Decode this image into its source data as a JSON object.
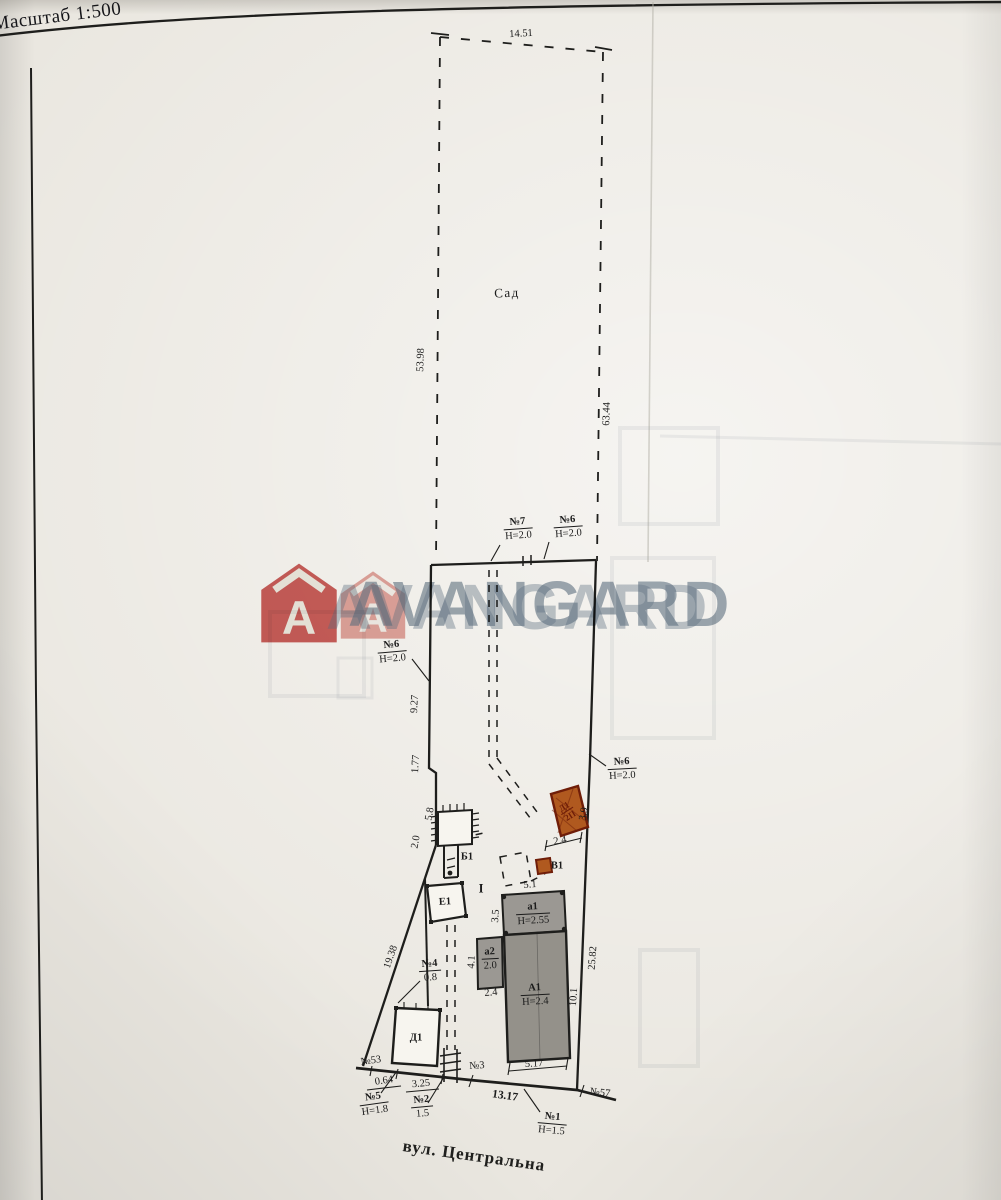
{
  "page": {
    "scale_label": "Масштаб 1:500",
    "street_label": "вул. Центральна"
  },
  "watermark": {
    "text": "AVANGARD",
    "logo_letter": "A"
  },
  "colors": {
    "ink": "#1e1e1c",
    "red_building": "#b0591f",
    "red_border": "#6f1d08",
    "gray_building": "#9b9893",
    "gray_building2": "#94918a",
    "wm_red": "#c64a47",
    "wm_red_light": "#d06156",
    "wm_blue": "#5e7286"
  },
  "plan": {
    "labels": [
      {
        "t": "14.51",
        "x": 521,
        "y": 34,
        "r": -3,
        "c": "dim"
      },
      {
        "t": "Сад",
        "x": 507,
        "y": 293,
        "r": -2,
        "c": "area"
      },
      {
        "t": "53.98",
        "x": 421,
        "y": 360,
        "r": -88,
        "c": "dim"
      },
      {
        "t": "63.44",
        "x": 607,
        "y": 414,
        "r": -88,
        "c": "dim"
      },
      {
        "t": "9.27",
        "x": 415,
        "y": 704,
        "r": -87,
        "c": "dim"
      },
      {
        "t": "1.77",
        "x": 416,
        "y": 764,
        "r": -87,
        "c": "dim"
      },
      {
        "t": "5.8",
        "x": 430,
        "y": 814,
        "r": -80,
        "c": "dim"
      },
      {
        "t": "2.0",
        "x": 416,
        "y": 842,
        "r": -80,
        "c": "dim"
      },
      {
        "t": "3.9",
        "x": 584,
        "y": 814,
        "r": -80,
        "c": "dim"
      },
      {
        "t": "2.4",
        "x": 560,
        "y": 841,
        "r": -10,
        "c": "dim"
      },
      {
        "t": "5.1",
        "x": 530,
        "y": 885,
        "r": -4,
        "c": "dim"
      },
      {
        "t": "3.5",
        "x": 496,
        "y": 916,
        "r": -86,
        "c": "dim"
      },
      {
        "t": "4.1",
        "x": 472,
        "y": 962,
        "r": -86,
        "c": "dim"
      },
      {
        "t": "2.4",
        "x": 491,
        "y": 993,
        "r": -5,
        "c": "dim"
      },
      {
        "t": "10.1",
        "x": 574,
        "y": 997,
        "r": -86,
        "c": "dim"
      },
      {
        "t": "25.82",
        "x": 593,
        "y": 958,
        "r": -86,
        "c": "dim"
      },
      {
        "t": "19.38",
        "x": 391,
        "y": 957,
        "r": -71,
        "c": "dim"
      },
      {
        "t": "5.17",
        "x": 534,
        "y": 1064,
        "r": -3,
        "c": "dim"
      },
      {
        "t": "0.64",
        "x": 384,
        "y": 1081,
        "r": -8,
        "c": "dim"
      },
      {
        "t": "3.25",
        "x": 421,
        "y": 1084,
        "r": -5,
        "c": "dim"
      },
      {
        "t": "13.17",
        "x": 505,
        "y": 1096,
        "r": 8,
        "c": "dim13"
      },
      {
        "t": "Б1",
        "x": 467,
        "y": 857,
        "r": 0,
        "c": "bld"
      },
      {
        "t": "Е1",
        "x": 445,
        "y": 902,
        "r": -3,
        "c": "bld"
      },
      {
        "t": "В1",
        "x": 557,
        "y": 866,
        "r": 0,
        "c": "bld"
      },
      {
        "t": "Д1",
        "x": 416,
        "y": 1038,
        "r": 0,
        "c": "bld"
      },
      {
        "t": "I",
        "x": 481,
        "y": 889,
        "r": 0,
        "c": "roman"
      },
      {
        "t": "№3",
        "x": 477,
        "y": 1066,
        "r": -4,
        "c": "dim"
      },
      {
        "t": "№53",
        "x": 371,
        "y": 1061,
        "r": -8,
        "c": "dim"
      },
      {
        "t": "№57",
        "x": 600,
        "y": 1093,
        "r": 6,
        "c": "dim"
      }
    ],
    "stacks": [
      {
        "a": "№7",
        "b": "Н=2.0",
        "x": 518,
        "y": 529,
        "r": -4,
        "c": ""
      },
      {
        "a": "№6",
        "b": "Н=2.0",
        "x": 568,
        "y": 527,
        "r": -4,
        "c": ""
      },
      {
        "a": "№6",
        "b": "Н=2.0",
        "x": 392,
        "y": 652,
        "r": -5,
        "c": ""
      },
      {
        "a": "№6",
        "b": "Н=2.0",
        "x": 622,
        "y": 769,
        "r": -3,
        "c": ""
      },
      {
        "a": "№4",
        "b": "0.8",
        "x": 430,
        "y": 971,
        "r": -4,
        "c": ""
      },
      {
        "a": "№5",
        "b": "Н=1.8",
        "x": 374,
        "y": 1104,
        "r": -8,
        "c": ""
      },
      {
        "a": "№2",
        "b": "1.5",
        "x": 422,
        "y": 1107,
        "r": -5,
        "c": ""
      },
      {
        "a": "№1",
        "b": "Н=1.5",
        "x": 552,
        "y": 1124,
        "r": 5,
        "c": ""
      },
      {
        "a": "а1",
        "b": "Н=2.55",
        "x": 533,
        "y": 914,
        "r": -3,
        "c": ""
      },
      {
        "a": "а2",
        "b": "2.0",
        "x": 490,
        "y": 959,
        "r": -3,
        "c": ""
      },
      {
        "a": "А1",
        "b": "Н=2.4",
        "x": 535,
        "y": 995,
        "r": -3,
        "c": ""
      },
      {
        "a": "Д1",
        "b": "2П",
        "x": 567,
        "y": 811,
        "r": -33,
        "c": "redstk"
      }
    ]
  }
}
